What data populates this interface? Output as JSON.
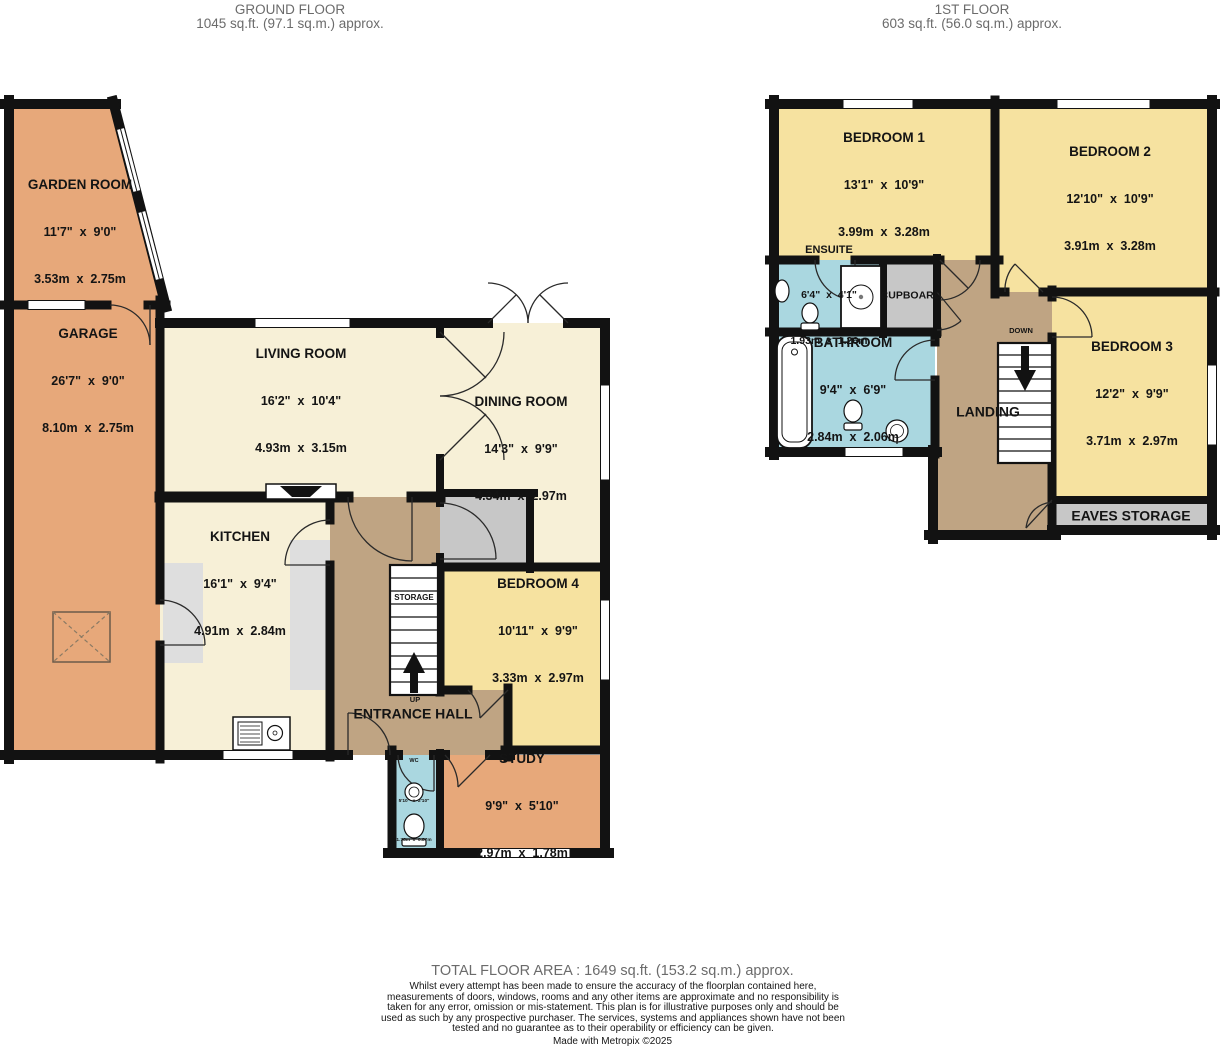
{
  "floors": {
    "ground": {
      "title": "GROUND FLOOR",
      "area": "1045 sq.ft. (97.1 sq.m.) approx."
    },
    "first": {
      "title": "1ST FLOOR",
      "area": "603 sq.ft. (56.0 sq.m.) approx."
    }
  },
  "rooms": {
    "garden_room": {
      "name": "GARDEN ROOM",
      "imperial": "11'7\"  x  9'0\"",
      "metric": "3.53m  x  2.75m"
    },
    "garage": {
      "name": "GARAGE",
      "imperial": "26'7\"  x  9'0\"",
      "metric": "8.10m  x  2.75m"
    },
    "living_room": {
      "name": "LIVING ROOM",
      "imperial": "16'2\"  x  10'4\"",
      "metric": "4.93m  x  3.15m"
    },
    "dining_room": {
      "name": "DINING ROOM",
      "imperial": "14'3\"  x  9'9\"",
      "metric": "4.34m  x  2.97m"
    },
    "kitchen": {
      "name": "KITCHEN",
      "imperial": "16'1\"  x  9'4\"",
      "metric": "4.91m  x  2.84m"
    },
    "bedroom4": {
      "name": "BEDROOM 4",
      "imperial": "10'11\"  x  9'9\"",
      "metric": "3.33m  x  2.97m"
    },
    "entrance_hall": {
      "name": "ENTRANCE HALL"
    },
    "study": {
      "name": "STUDY",
      "imperial": "9'9\"  x  5'10\"",
      "metric": "2.97m  x  1.78m"
    },
    "wc": {
      "name": "WC",
      "imperial": "5'10\"  x  2'10\"",
      "metric": "1.78m  x  0.87m"
    },
    "bedroom1": {
      "name": "BEDROOM 1",
      "imperial": "13'1\"  x  10'9\"",
      "metric": "3.99m  x  3.28m"
    },
    "bedroom2": {
      "name": "BEDROOM 2",
      "imperial": "12'10\"  x  10'9\"",
      "metric": "3.91m  x  3.28m"
    },
    "bedroom3": {
      "name": "BEDROOM 3",
      "imperial": "12'2\"  x  9'9\"",
      "metric": "3.71m  x  2.97m"
    },
    "ensuite": {
      "name": "ENSUITE",
      "imperial": "6'4\"  x  4'1\"",
      "metric": "1.93m  x  1.26m"
    },
    "bathroom": {
      "name": "BATHROOM",
      "imperial": "9'4\"  x  6'9\"",
      "metric": "2.84m  x  2.06m"
    },
    "landing": {
      "name": "LANDING"
    },
    "cupboard": {
      "name": "CUPBOARD"
    },
    "eaves_storage": {
      "name": "EAVES STORAGE"
    }
  },
  "stairs": {
    "storage": "STORAGE",
    "up": "UP",
    "down": "DOWN"
  },
  "footer": {
    "total": "TOTAL FLOOR AREA : 1649 sq.ft. (153.2 sq.m.) approx.",
    "disclaimer": "Whilst every attempt has been made to ensure the accuracy of the floorplan contained here, measurements of doors, windows, rooms and any other items are approximate and no responsibility is taken for any error, omission or mis-statement. This plan is for illustrative purposes only and should be used as such by any prospective purchaser. The services, systems and appliances shown have not been tested and no guarantee as to their operability or efficiency can be given.",
    "credit": "Made with Metropix ©2025"
  },
  "colors": {
    "peach": "#e7a87a",
    "cream": "#f7f0d7",
    "yellow": "#f6e2a0",
    "hall_brown": "#bfa483",
    "bath_blue": "#aad7e0",
    "storage_grey": "#c7c7c7",
    "alcove_grey": "#dedede",
    "wall": "#121212"
  }
}
